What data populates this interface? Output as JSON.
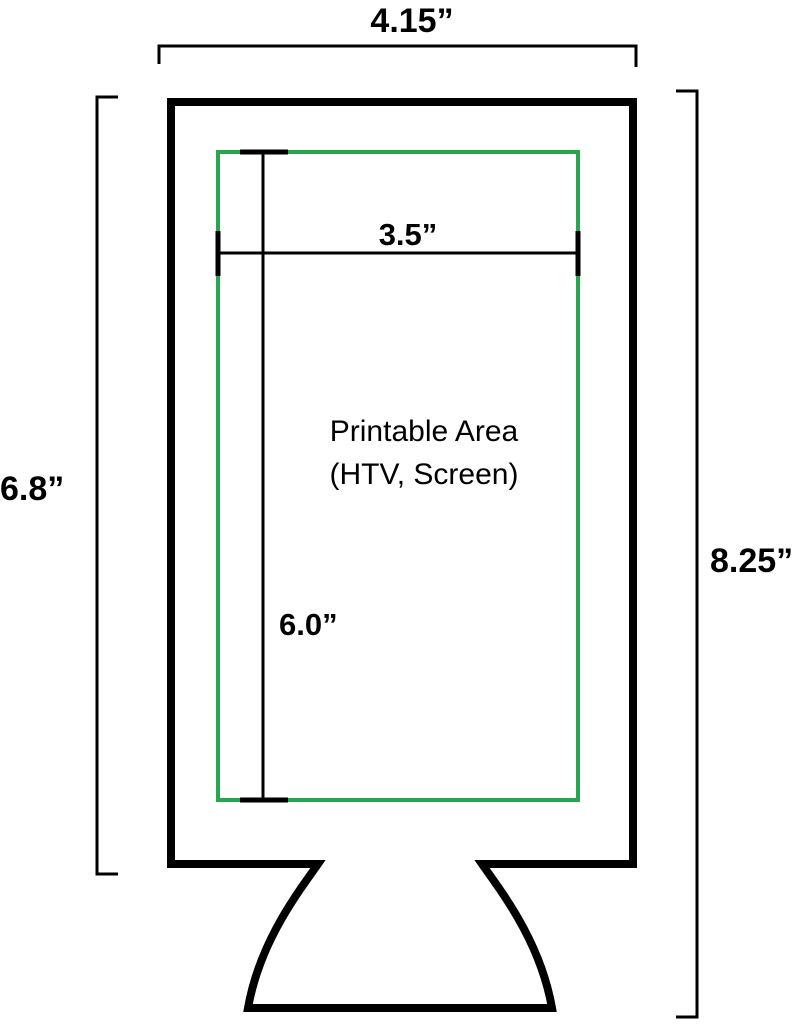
{
  "diagram": {
    "labels": {
      "overall_width": "4.15”",
      "body_height": "6.8”",
      "overall_height": "8.25”",
      "printable_width": "3.5”",
      "printable_height": "6.0”",
      "printable_area_line1": "Printable Area",
      "printable_area_line2": "(HTV, Screen)"
    },
    "colors": {
      "outline": "#000000",
      "printable_border": "#27a64f",
      "dimension_lines": "#000000",
      "background": "#ffffff",
      "text": "#000000"
    }
  }
}
